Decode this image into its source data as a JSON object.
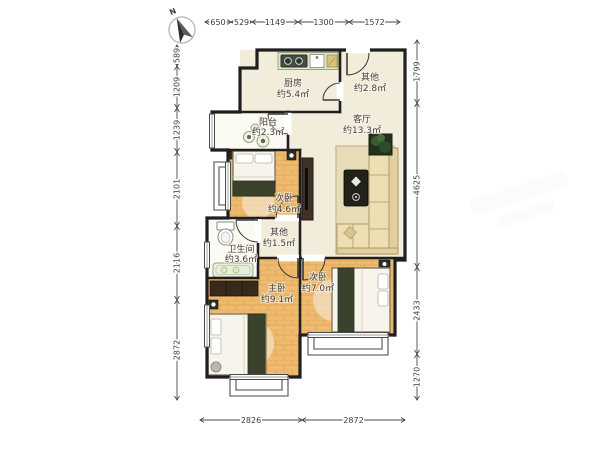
{
  "compass": {
    "north_label": "N"
  },
  "dimensions": {
    "top": [
      "650",
      "529",
      "1149",
      "1300",
      "1572"
    ],
    "left": [
      "589",
      "1209",
      "1239",
      "2101",
      "2116",
      "2872"
    ],
    "right": [
      "1799",
      "4625",
      "2433",
      "1270"
    ],
    "bottom": [
      "2826",
      "2872"
    ]
  },
  "rooms": {
    "kitchen": {
      "name": "厨房",
      "area": "约5.4㎡"
    },
    "other_top": {
      "name": "其他",
      "area": "约2.8㎡"
    },
    "balcony": {
      "name": "阳台",
      "area": "约2.3㎡"
    },
    "living": {
      "name": "客厅",
      "area": "约13.3㎡"
    },
    "bedroom_small": {
      "name": "次卧",
      "area": "约4.6㎡"
    },
    "other_hall": {
      "name": "其他",
      "area": "约1.5㎡"
    },
    "bathroom": {
      "name": "卫生间",
      "area": "约3.6㎡"
    },
    "master": {
      "name": "主卧",
      "area": "约9.1㎡"
    },
    "bedroom_right": {
      "name": "次卧",
      "area": "约7.0㎡"
    }
  },
  "colors": {
    "wall": "#1f1f1f",
    "floor_cream": "#f2ecda",
    "floor_light": "#fbfaf3",
    "wood_base": "#eebb6e",
    "wood_line": "#dfa45a",
    "blanket": "#3a422b",
    "furn_dark": "#38291a"
  }
}
